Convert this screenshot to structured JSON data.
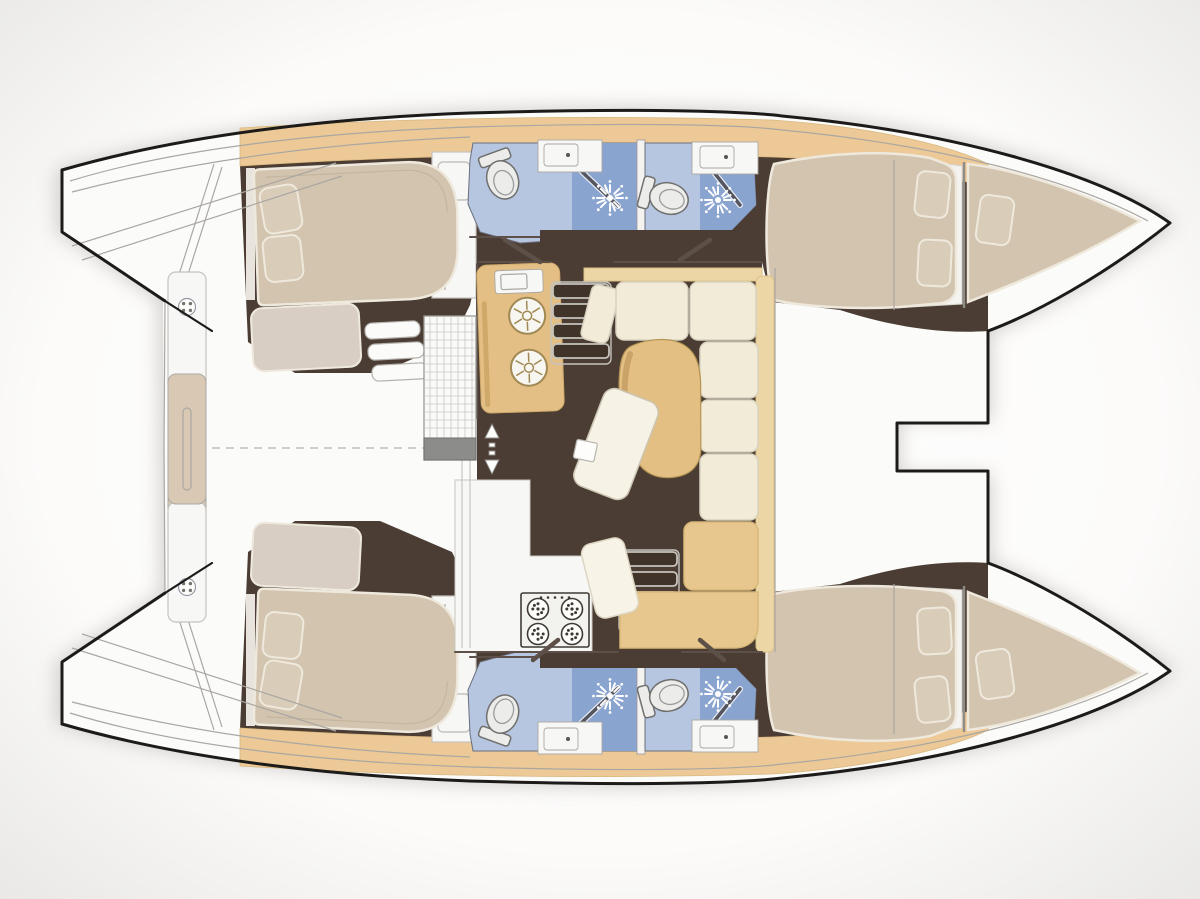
{
  "diagram": {
    "kind": "catamaran-interior-floor-plan",
    "view": "overhead",
    "bow_direction": "right",
    "hulls": [
      "upper-hull",
      "lower-hull"
    ]
  },
  "colors": {
    "bgEdge": "#e7e6e4",
    "bgCenter": "#ffffff",
    "shadow": "#9e9a94",
    "hullOutline": "#1c1b19",
    "deckWhite": "#fbfbf9",
    "wallGrey": "#aaa7a2",
    "wallDark": "#5c5048",
    "stepEdge": "#c6c3bd",
    "floorBrown": "#4b3d33",
    "woodTan": "#e3bf85",
    "walkwayTan": "#ecc997",
    "walkwayEdge": "#d9b87e",
    "trimTan": "#ecd6a6",
    "trimEdge": "#dcc187",
    "sofaCream": "#f2ebd7",
    "sofaSeam": "#d8d2c0",
    "sofaTan": "#e8c78e",
    "sofaTanSeam": "#d8b878",
    "mattressBeige": "#d2c4ae",
    "mattressEdge": "#efe9dd",
    "pillowBeige": "#d9ccb8",
    "benchTaupe": "#d8cec3",
    "bathFloorBlue": "#b6c5e0",
    "bathShowerBlue": "#8aa4d0",
    "fixtureWhite": "#ececea",
    "fixtureEdge": "#6f6f6d",
    "counterWhite": "#f7f7f5",
    "ladderTan": "#d9c9b4",
    "gridGrey": "#c9c7c2",
    "stoveDark": "#3f3a34",
    "sinkRing": "#a08954",
    "tableWood": "#e4bf84",
    "tableEdge": "#b59553",
    "tableShade": "#c9a368",
    "stairTread": "#3f332a"
  },
  "salon_features": [
    "galley-double-sink",
    "galley-appliance",
    "fridge-grate",
    "cockpit-steps",
    "stove-4-burner",
    "dining-table",
    "chaise-seat",
    "stool",
    "u-sofa",
    "companionway-stairs-upper",
    "companionway-stairs-lower",
    "sliding-door-arrows"
  ],
  "hull_features": [
    "aft-cabin-island-bed",
    "bed-pillows",
    "seat-bench",
    "wardrobe",
    "aft-head",
    "forward-head",
    "toilet",
    "shower-drain",
    "sink",
    "forward-cabin-bed",
    "bow-berth",
    "swim-ladder",
    "transom-steps"
  ]
}
